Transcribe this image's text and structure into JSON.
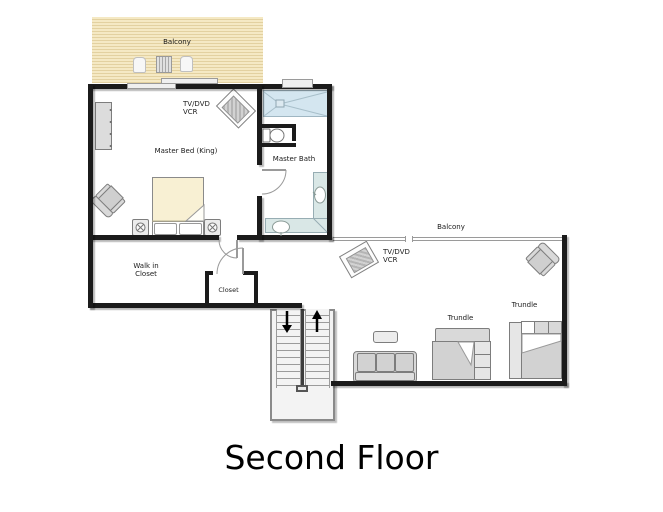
{
  "title": "Second Floor",
  "labels": {
    "balcony_top": "Balcony",
    "balcony_right": "Balcony",
    "master_bedroom": "Master Bed (King)",
    "master_bath": "Master Bath",
    "walk_in_closet_line1": "Walk in",
    "walk_in_closet_line2": "Closet",
    "closet": "Closet",
    "tv1_line1": "TV/DVD",
    "tv1_line2": "VCR",
    "tv2_line1": "TV/DVD",
    "tv2_line2": "VCR",
    "trundle_left": "Trundle",
    "trundle_right": "Trundle"
  },
  "icons": {
    "stairs_down_arrow": "down-arrow",
    "stairs_up_arrow": "up-arrow",
    "tv": "rotated-tv-box",
    "armchair": "top-view-armchair",
    "lamp": "circle-with-spokes"
  },
  "colors": {
    "wall": "#1b1b1b",
    "balcony_deck": "#f5e9c4",
    "balcony_stripe": "#e3d1a0",
    "shower_tile": "#d4e6f0",
    "vanity_counter": "#d9e7e6",
    "furniture_gray": "#d9d9d9",
    "furniture_light": "#ececec",
    "bed_blanket": "#f8f0d3",
    "outline_gray": "#7d7d7d",
    "text": "#1a1a1a"
  }
}
